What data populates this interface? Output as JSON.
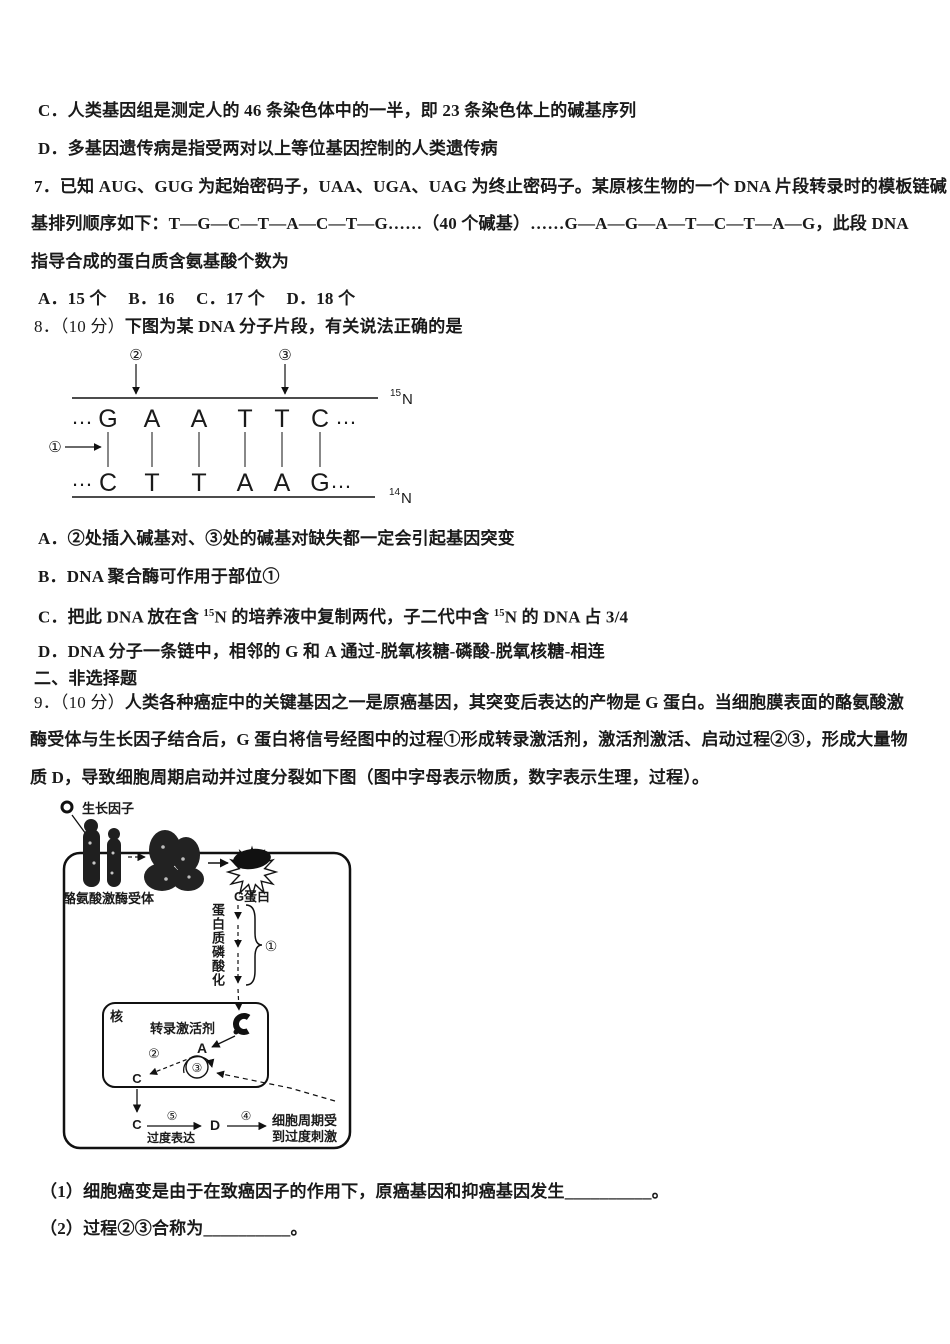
{
  "colors": {
    "text": "#1a1a1a",
    "background": "#ffffff"
  },
  "question6": {
    "option_c": "C．人类基因组是测定人的 46 条染色体中的一半，即 23 条染色体上的碱基序列",
    "option_d": "D．多基因遗传病是指受两对以上等位基因控制的人类遗传病"
  },
  "question7": {
    "line1": "7．已知 AUG、GUG 为起始密码子，UAA、UGA、UAG 为终止密码子。某原核生物的一个 DNA 片段转录时的模板链碱",
    "line2": "基排列顺序如下：T—G—C—T—A—C—T—G……（40 个碱基）……G—A—G—A—T—C—T—A—G，此段 DNA",
    "line3": "指导合成的蛋白质含氨基酸个数为",
    "options_line": "A．15 个　 B．16　 C．17 个　 D．18 个"
  },
  "question8": {
    "number": "8．（10 分）",
    "stem": "下图为某 DNA 分子片段，有关说法正确的是",
    "option_a": "A．②处插入碱基对、③处的碱基对缺失都一定会引起基因突变",
    "option_b": "B．DNA 聚合酶可作用于部位①",
    "option_c": {
      "pre": "C．把此 DNA 放在含 ",
      "sup1": "15",
      "mid": "N 的培养液中复制两代，子二代中含 ",
      "sup2": "15",
      "post": "N 的 DNA 占 3/4"
    },
    "option_d": "D．DNA 分子一条链中，相邻的 G 和 A 通过-脱氧核糖-磷酸-脱氧核糖-相连"
  },
  "dna_figure": {
    "marker1": "①",
    "marker2": "②",
    "marker3": "③",
    "ellipsis": "…",
    "top_strand": [
      "G",
      "A",
      "A",
      "T",
      "T",
      "C"
    ],
    "bottom_strand": [
      "C",
      "T",
      "T",
      "A",
      "A",
      "G"
    ],
    "n15": {
      "sup": "15",
      "base": "N"
    },
    "n14": {
      "sup": "14",
      "base": "N"
    }
  },
  "section2": {
    "title": "二、非选择题"
  },
  "question9": {
    "number": "9．（10 分）",
    "line1_rest": "人类各种癌症中的关键基因之一是原癌基因，其突变后表达的产物是 G 蛋白。当细胞膜表面的酪氨酸激",
    "line2": "酶受体与生长因子结合后，G 蛋白将信号经图中的过程①形成转录激活剂，激活剂激活、启动过程②③，形成大量物",
    "line3": "质 D，导致细胞周期启动并过度分裂如下图（图中字母表示物质，数字表示生理，过程）。",
    "sub1": "（1）细胞癌变是由于在致癌因子的作用下，原癌基因和抑癌基因发生__________。",
    "sub2": "（2）过程②③合称为__________。"
  },
  "cell_figure": {
    "growth_factor": "生长因子",
    "receptor_label": "酪氨酸激酶受体",
    "g_protein": "G蛋白",
    "phosphorylation": "蛋白质磷酸化",
    "process1": "①",
    "nucleus_label": "核",
    "activator_label": "转录激活剂",
    "substance_a": "A",
    "process2": "②",
    "process3": "③",
    "substance_c_nucleus": "C",
    "substance_c_cytoplasm": "C",
    "process5": "⑤",
    "overexpression": "过度表达",
    "substance_d": "D",
    "process4": "④",
    "stimulus_line1": "细胞周期受",
    "stimulus_line2": "到过度刺激"
  }
}
